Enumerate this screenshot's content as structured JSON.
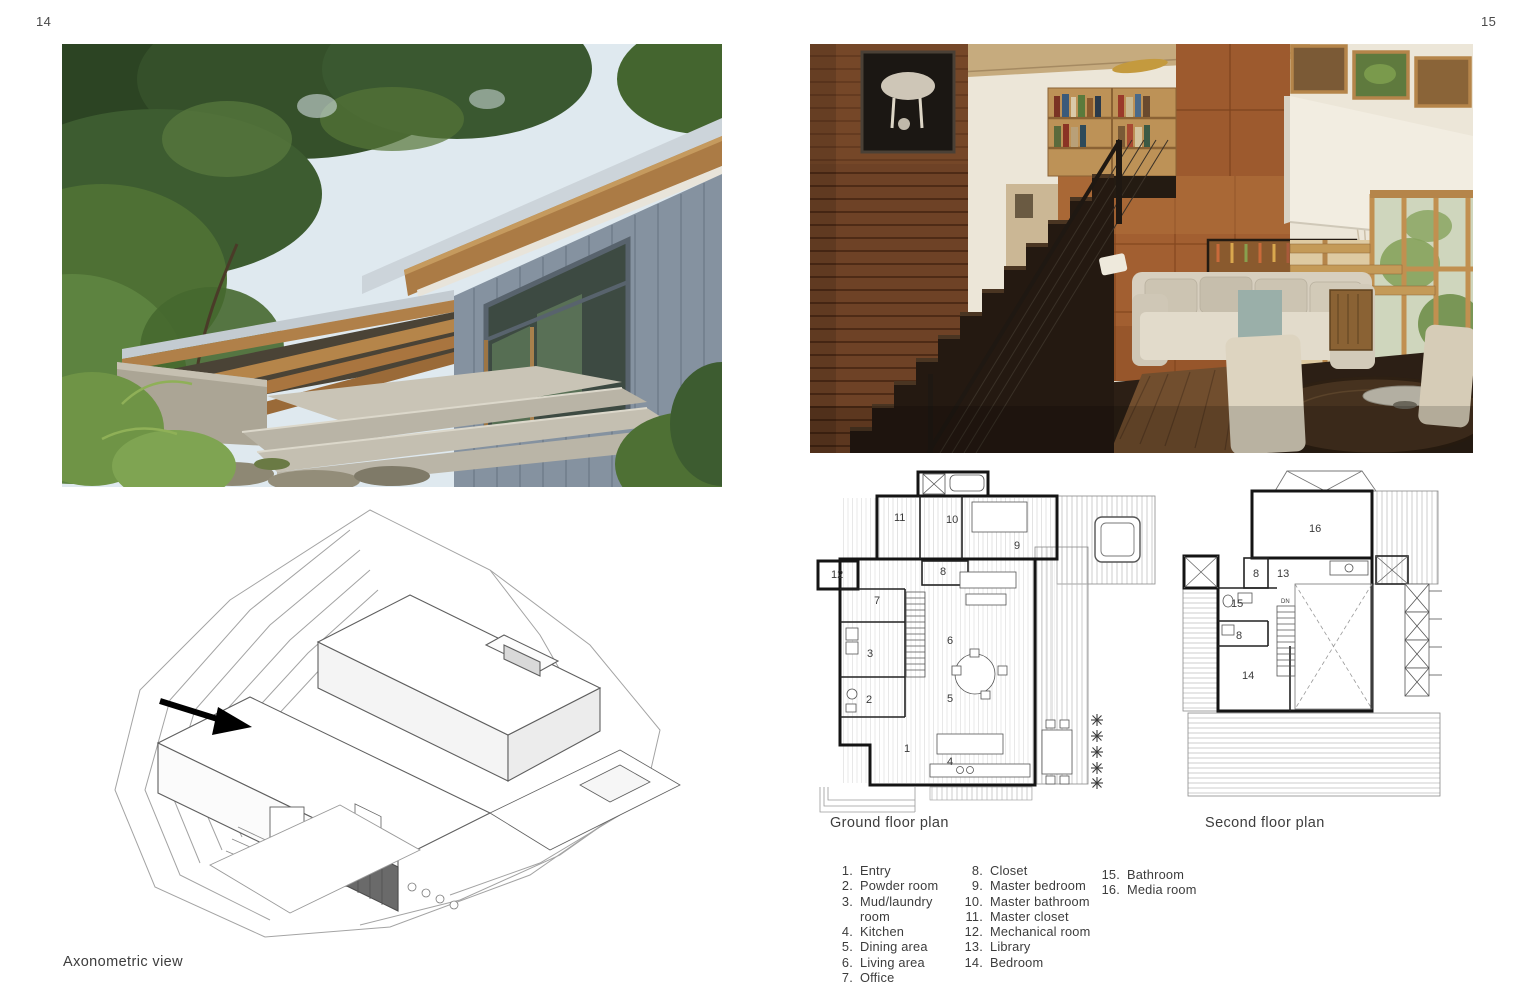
{
  "page": {
    "left_number": "14",
    "right_number": "15"
  },
  "captions": {
    "axonometric": "Axonometric view",
    "ground_floor": "Ground floor plan",
    "second_floor": "Second floor plan"
  },
  "legend": {
    "col1": [
      {
        "n": "1.",
        "t": "Entry"
      },
      {
        "n": "2.",
        "t": "Powder room"
      },
      {
        "n": "3.",
        "t": "Mud/laundry room"
      },
      {
        "n": "4.",
        "t": "Kitchen"
      },
      {
        "n": "5.",
        "t": "Dining area"
      },
      {
        "n": "6.",
        "t": "Living area"
      },
      {
        "n": "7.",
        "t": "Office"
      }
    ],
    "col2": [
      {
        "n": "8.",
        "t": "Closet"
      },
      {
        "n": "9.",
        "t": "Master bedroom"
      },
      {
        "n": "10.",
        "t": "Master bathroom"
      },
      {
        "n": "11.",
        "t": "Master closet"
      },
      {
        "n": "12.",
        "t": "Mechanical room"
      },
      {
        "n": "13.",
        "t": "Library"
      },
      {
        "n": "14.",
        "t": "Bedroom"
      }
    ],
    "col3": [
      {
        "n": "15.",
        "t": "Bathroom"
      },
      {
        "n": "16.",
        "t": "Media room"
      }
    ]
  },
  "plans": {
    "ground": {
      "labels": [
        "11",
        "10",
        "9",
        "12",
        "8",
        "7",
        "6",
        "3",
        "2",
        "5",
        "1",
        "4"
      ]
    },
    "second": {
      "labels": [
        "16",
        "8",
        "13",
        "15",
        "8",
        "14"
      ],
      "stair_label": "DN"
    }
  },
  "colors": {
    "siding_gray": "#8592a0",
    "soffit_wood": "#ab7b45",
    "copper_wall": "#a25f31",
    "plank_wall": "#6e4226",
    "sofa_cream": "#ddd6c8",
    "caption_text": "#3d3d3d"
  }
}
